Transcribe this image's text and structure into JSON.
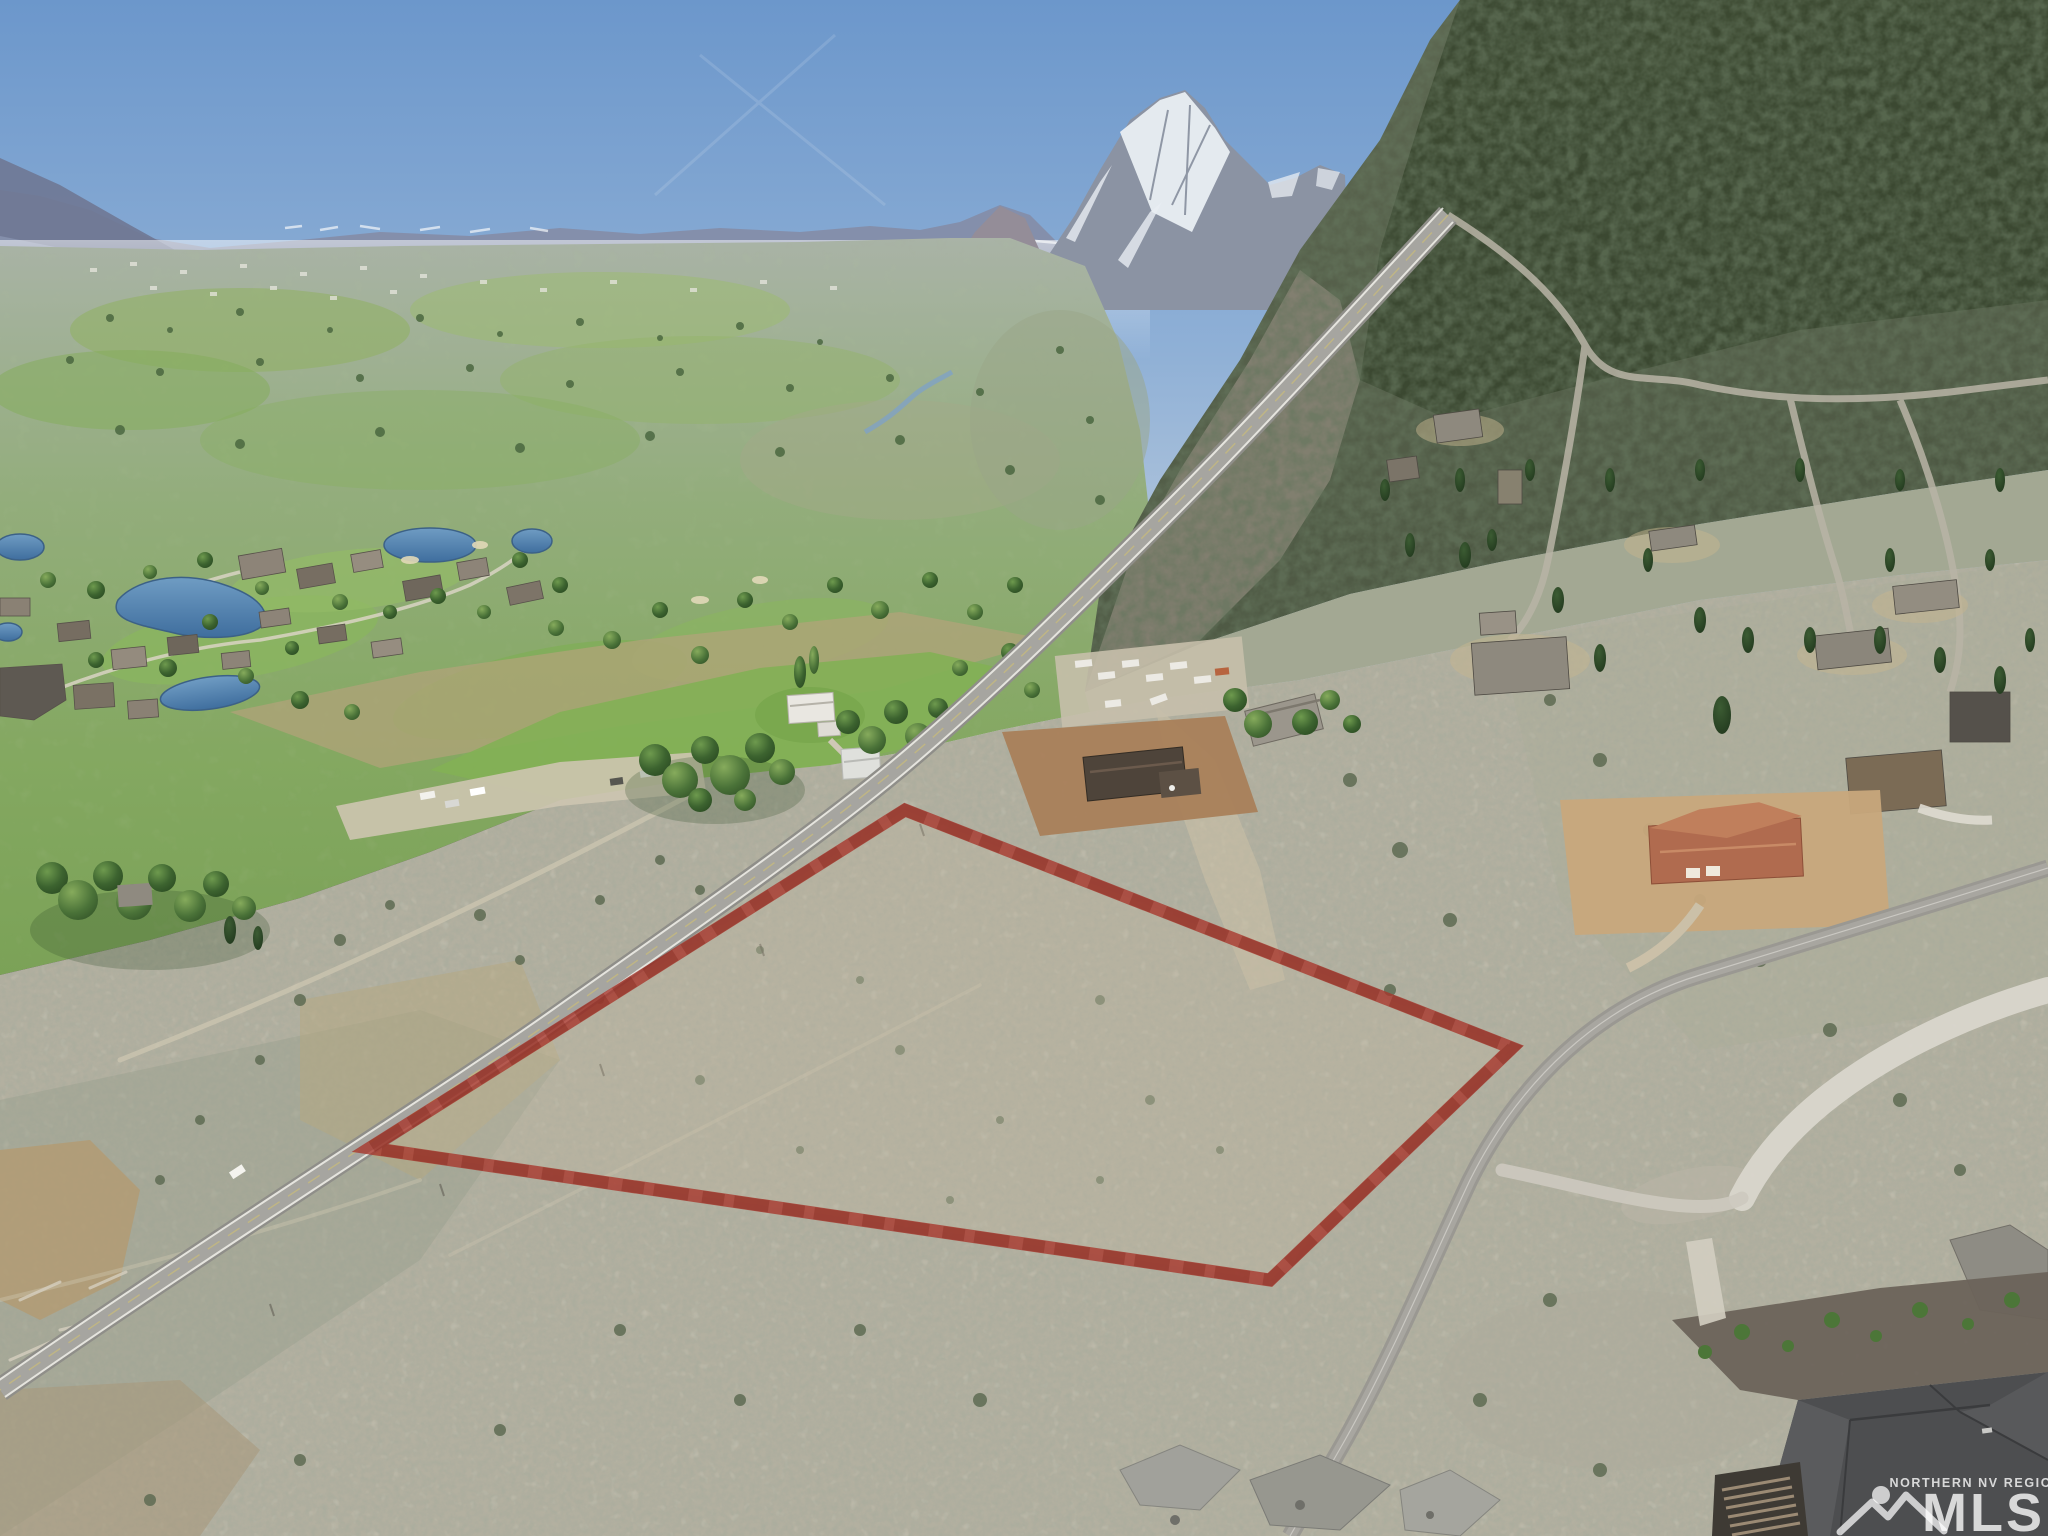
{
  "watermark": {
    "region_label": "NORTHERN NV REGIONAL",
    "brand": "MLS",
    "logo": "mountain-sun-logo",
    "color": "#ffffff"
  },
  "parcel": {
    "points": "905,810 1512,1048 1270,1280 370,1148",
    "outline_color": "#a8352a"
  },
  "palette": {
    "sky_top": "#6c97cb",
    "sky_horizon": "#d3dce5",
    "distant_range": "#848da9",
    "snow": "#eef2f6",
    "valley_green": "#7ba257",
    "fairway_green": "#8ab55f",
    "water": "#4f80ae",
    "forest": "#44523a",
    "sagebrush": "#b3b0a0",
    "dirt": "#a9805a",
    "asphalt": "#9e9d98",
    "concrete": "#d9d6cc",
    "terracotta_roof": "#b06b4f"
  }
}
